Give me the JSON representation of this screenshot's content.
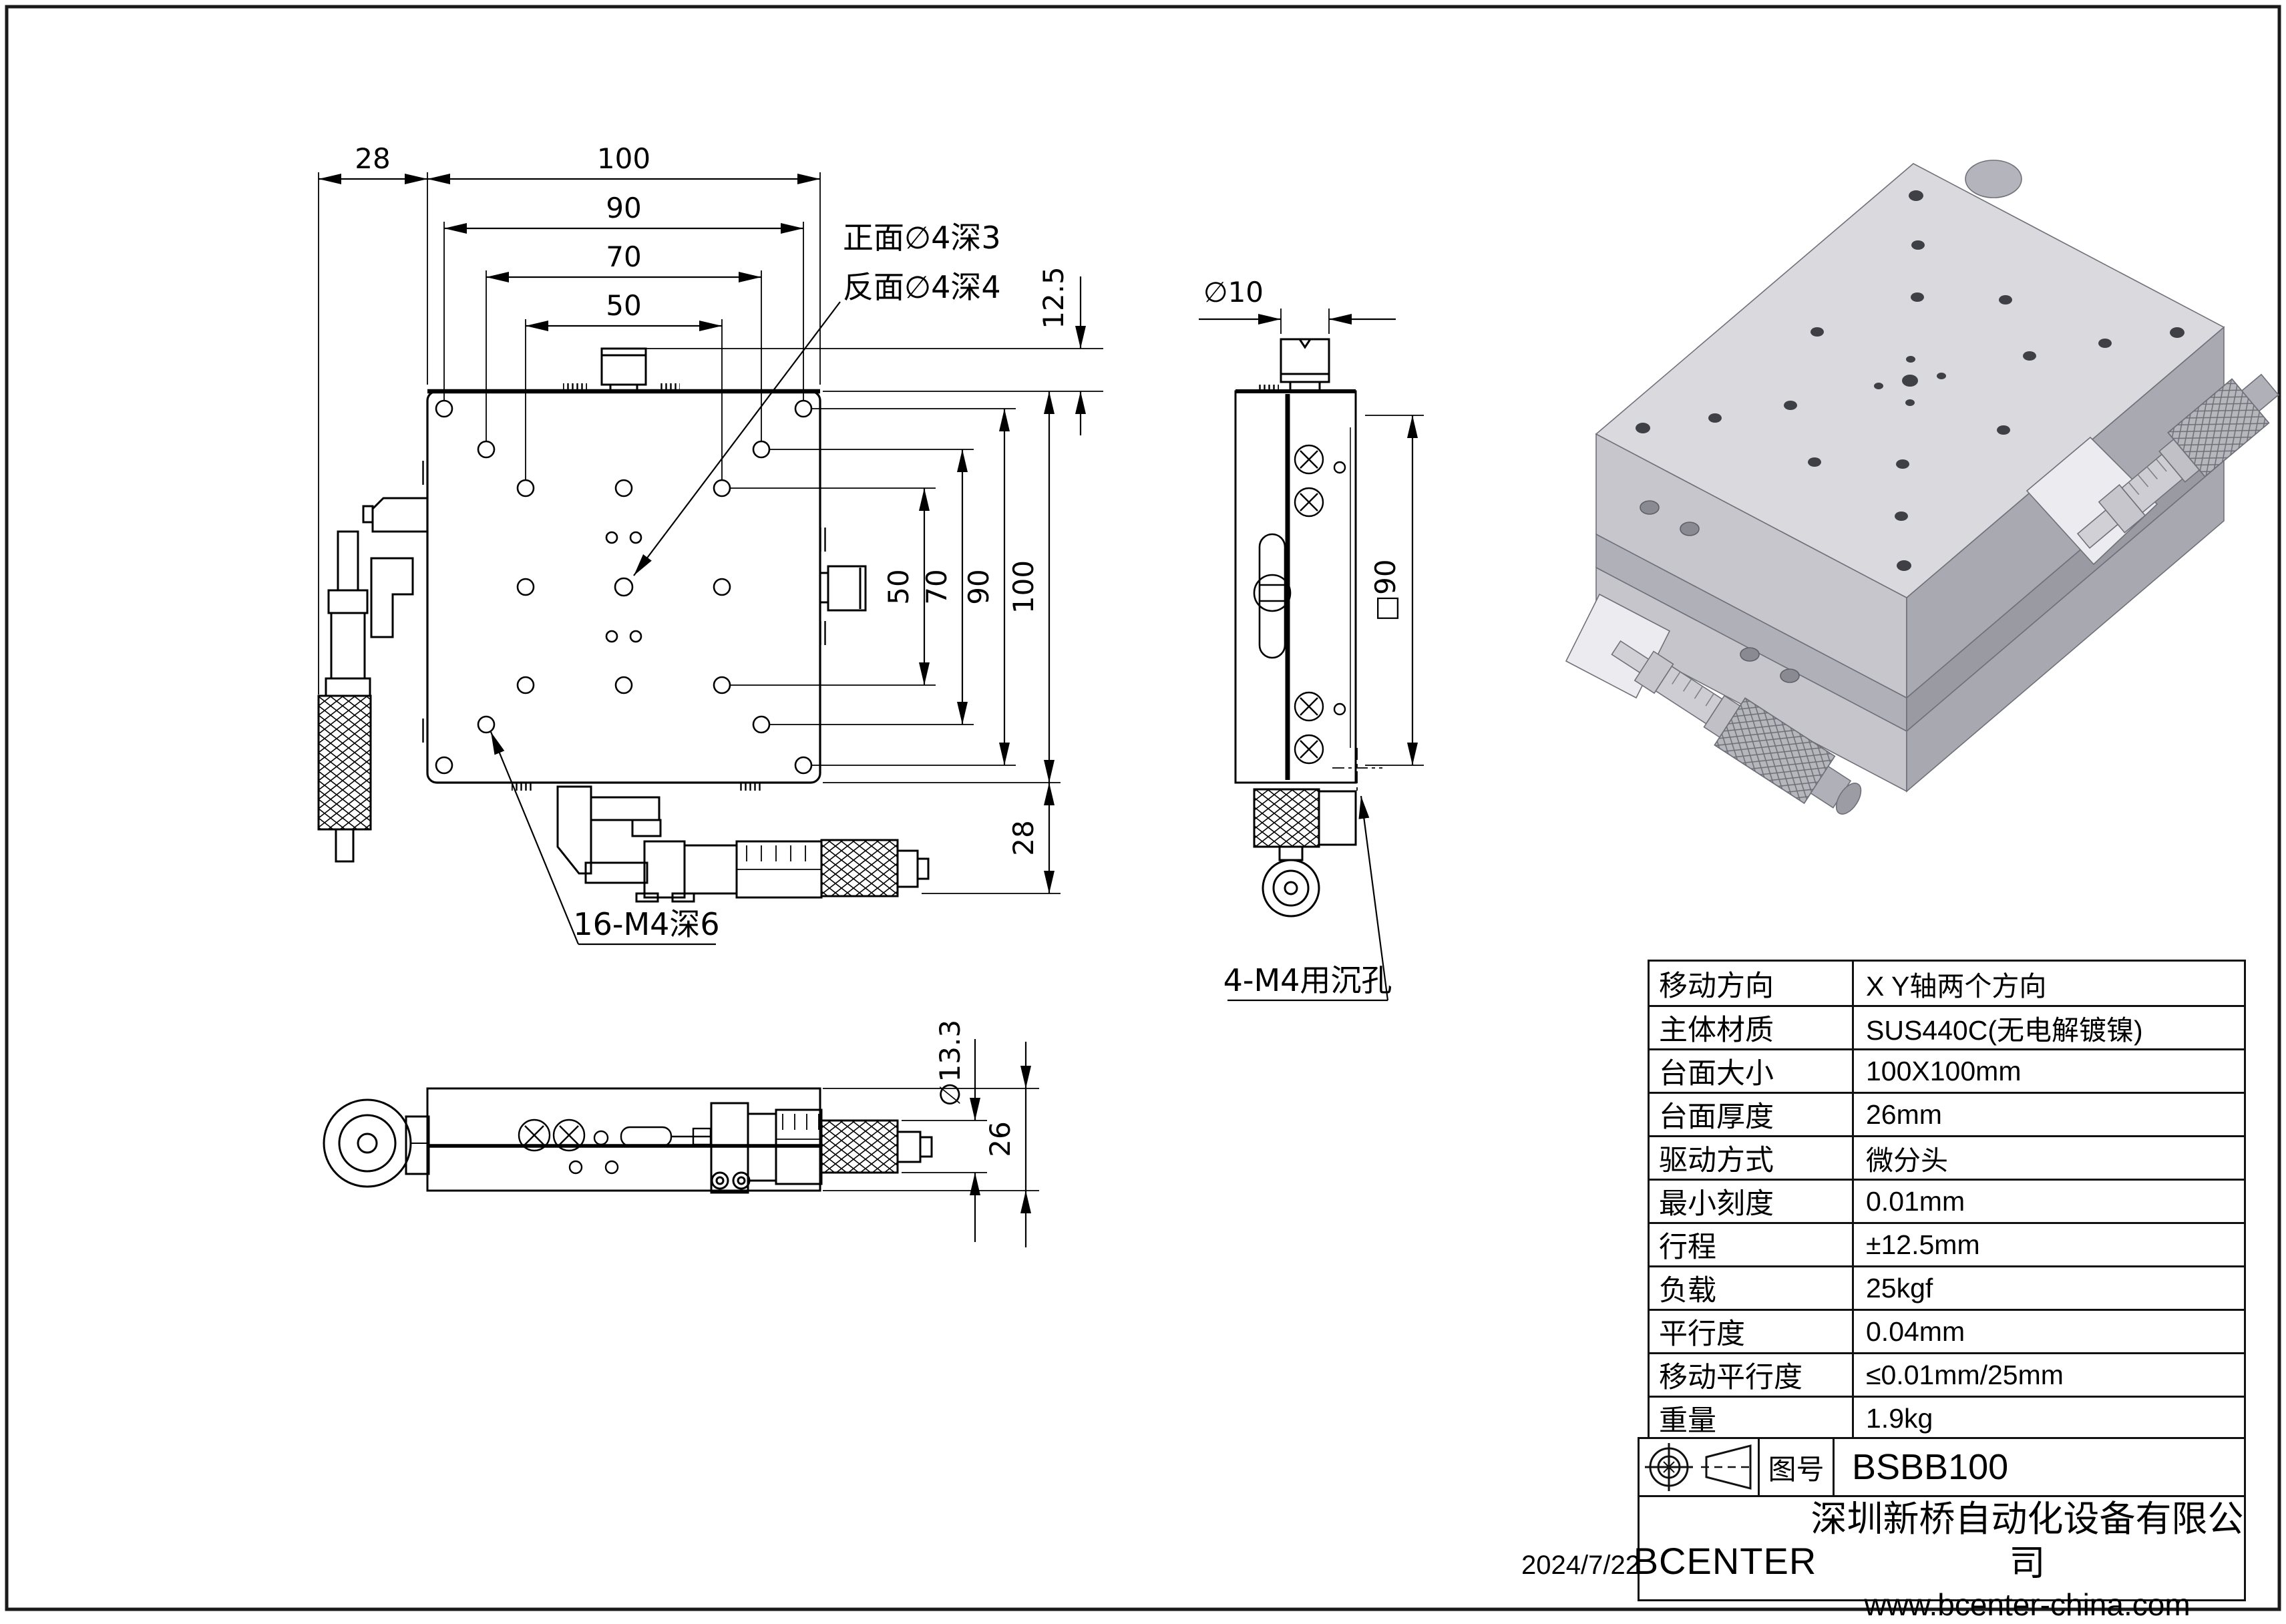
{
  "sheet": {
    "date": "2024/7/22"
  },
  "colors": {
    "line": "#000000",
    "sheet": "#ffffff",
    "iso_top": "#d9d9de",
    "iso_left": "#c6c6cc",
    "iso_right": "#a9a9b1"
  },
  "front_view": {
    "dim_28_left": "28",
    "dim_100_top": "100",
    "dim_90_top": "90",
    "dim_70_top": "70",
    "dim_50_top": "50",
    "dim_12_5": "12.5",
    "dim_50_right": "50",
    "dim_70_right": "70",
    "dim_90_right": "90",
    "dim_100_right": "100",
    "dim_28_bottom": "28",
    "callout_line1": "正面∅4深3",
    "callout_line2": "反面∅4深4",
    "label_holes": "16-M4深6"
  },
  "side_view": {
    "dim_dia10": "∅10",
    "dim_sq90": "□90",
    "label_holes": "4-M4用沉孔"
  },
  "bottom_view": {
    "dim_dia13_3": "∅13.3",
    "dim_26": "26"
  },
  "spec_table": {
    "rows": [
      {
        "label": "移动方向",
        "value": "X Y轴两个方向"
      },
      {
        "label": "主体材质",
        "value": "SUS440C(无电解镀镍)"
      },
      {
        "label": "台面大小",
        "value": "100X100mm"
      },
      {
        "label": "台面厚度",
        "value": "26mm"
      },
      {
        "label": "驱动方式",
        "value": "微分头"
      },
      {
        "label": "最小刻度",
        "value": "0.01mm"
      },
      {
        "label": "行程",
        "value": "±12.5mm"
      },
      {
        "label": "负载",
        "value": "25kgf"
      },
      {
        "label": "平行度",
        "value": "0.04mm"
      },
      {
        "label": "移动平行度",
        "value": "≤0.01mm/25mm"
      },
      {
        "label": "重量",
        "value": "1.9kg"
      }
    ]
  },
  "title_block": {
    "icons": [
      "datum-target-symbol",
      "cone-projection-symbol"
    ],
    "drawing_no_label": "图号",
    "drawing_no": "BSBB100",
    "brand": "BCENTER",
    "company": "深圳新桥自动化设备有限公司",
    "website": "www.bcenter-china.com"
  }
}
